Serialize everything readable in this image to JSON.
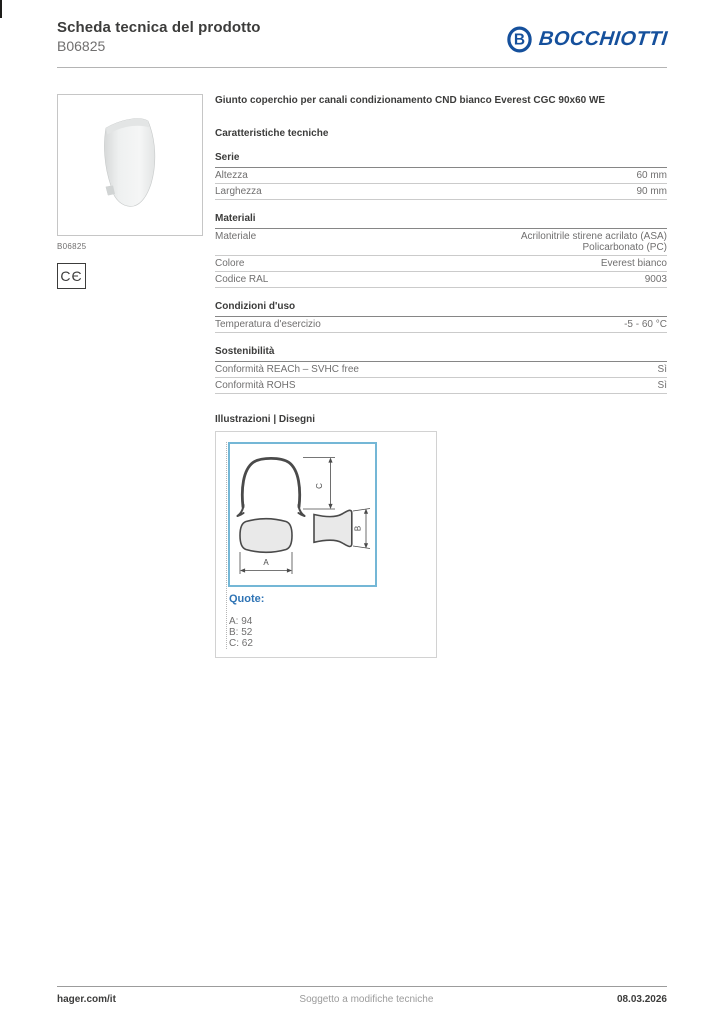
{
  "header": {
    "doc_title": "Scheda tecnica del prodotto",
    "product_code": "B06825",
    "brand": "BOCCHIOTTI"
  },
  "product": {
    "image_caption": "B06825",
    "ce_mark": "CЄ",
    "name": "Giunto coperchio per canali condizionamento CND bianco Everest CGC 90x60 WE"
  },
  "characteristics": {
    "heading": "Caratteristiche tecniche",
    "sections": [
      {
        "title": "Serie",
        "rows": [
          {
            "label": "Altezza",
            "value": "60 mm"
          },
          {
            "label": "Larghezza",
            "value": "90 mm"
          }
        ]
      },
      {
        "title": "Materiali",
        "rows": [
          {
            "label": "Materiale",
            "value": "Acrilonitrile stirene acrilato (ASA)\nPolicarbonato (PC)"
          },
          {
            "label": "Colore",
            "value": "Everest bianco"
          },
          {
            "label": "Codice RAL",
            "value": "9003"
          }
        ]
      },
      {
        "title": "Condizioni d'uso",
        "rows": [
          {
            "label": "Temperatura d'esercizio",
            "value": "-5 - 60 °C"
          }
        ]
      },
      {
        "title": "Sostenibilità",
        "rows": [
          {
            "label": "Conformità REACh – SVHC free",
            "value": "Sì"
          },
          {
            "label": "Conformità ROHS",
            "value": "Sì"
          }
        ]
      }
    ]
  },
  "illustrations": {
    "heading": "Illustrazioni | Disegni",
    "drawing_labels": {
      "a": "A",
      "b": "B",
      "c": "C"
    },
    "quote_label": "Quote:",
    "quote_lines": [
      "A: 94",
      "B: 52",
      "C: 62"
    ]
  },
  "footer": {
    "site": "hager.com/it",
    "note": "Soggetto a modifiche tecniche",
    "date": "08.03.2026"
  },
  "colors": {
    "brand_blue": "#15509c",
    "quote_blue": "#2f74b5",
    "drawing_frame_blue": "#74b7d6"
  }
}
